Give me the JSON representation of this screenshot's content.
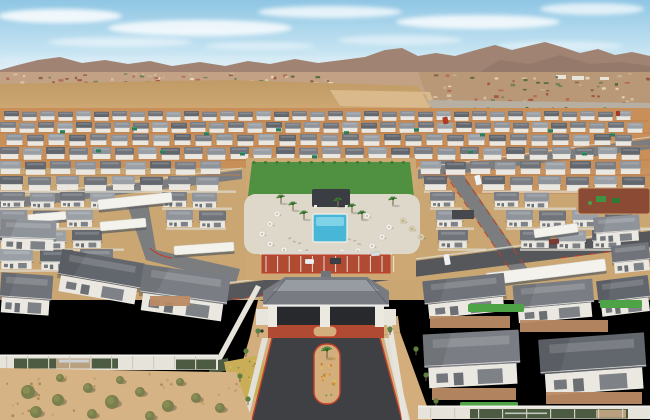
{
  "scene": {
    "description": "Aerial drone photograph of a new single-family rental home community in the desert: rows of gray-roofed houses, central pool amenity with palms and umbrellas, gated entry drive with hip-roof gatehouse, perimeter walls with green banners, open desert field, existing suburb and mountain range on the horizon under a hazy blue sky"
  },
  "colors": {
    "sky_top": "#8fc6e4",
    "sky_mid": "#c2e2f1",
    "sky_horizon": "#e2f0f6",
    "cloud": "#ffffff",
    "mountain_far": "#a18373",
    "mountain_near": "#8d7163",
    "suburb_base": "#c2a184",
    "suburb_right": "#b99878",
    "desert_field": "#c9a26b",
    "desert_mound": "#dcbd8f",
    "arterial_road": "#b6afa2",
    "dirt_construction": "#c88f59",
    "ground_mid": "#c9a672",
    "street_gray": "#7b7d7f",
    "asphalt_new": "#3e4044",
    "sidewalk": "#ddd9cf",
    "red_curb": "#c23f28",
    "red_paving": "#b04a33",
    "wall_house": "#ebe8e1",
    "lawn": "#4f9140",
    "turf": "#4da345",
    "pool_water": "#48b7d7",
    "pool_shallow": "#7fd2e8",
    "pool_deck": "#ddd8ca",
    "pavilion": "#3a3d41",
    "umbrella_white": "#f1eee6",
    "umbrella_tan": "#d9c9a9",
    "canopy_white": "#f4f2ec",
    "dumpster_green": "#2e7c5c",
    "banner_green": "#4d5b43",
    "banner_photo": "#b9a07e",
    "perimeter_wall": "#e6e3db",
    "paver": "#bb8a64",
    "gravel": "#d3ae7c",
    "shrub": "#7b7f4e",
    "palm_frond": "#3e7a33",
    "palm_trunk": "#8a7354",
    "flower_patch": "#c9ae57",
    "playground_mulch": "#8a4a34",
    "playground_green": "#3f9242",
    "gate_roof": "#787c82",
    "gate_roof_ridge": "#9aa0a6",
    "gate_opening": "#27292c",
    "column_white": "#ece9e1",
    "desert_foreground": "#d6b384",
    "roof_palette": [
      "#62666d",
      "#7a7e84",
      "#8f939a",
      "#70747a",
      "#9aa0a6"
    ]
  },
  "sky": {
    "clouds": [
      [
        60,
        16,
        62,
        7,
        0.85
      ],
      [
        200,
        28,
        92,
        8,
        0.8
      ],
      [
        330,
        12,
        72,
        6,
        0.75
      ],
      [
        478,
        22,
        82,
        7,
        0.8
      ],
      [
        592,
        9,
        52,
        6,
        0.7
      ],
      [
        120,
        42,
        72,
        5,
        0.5
      ],
      [
        400,
        40,
        62,
        5,
        0.45
      ],
      [
        560,
        46,
        62,
        5,
        0.4
      ],
      [
        260,
        46,
        55,
        4,
        0.4
      ]
    ]
  },
  "horizon": {
    "speck_count": 150,
    "tree_count": 16,
    "white_buildings": [
      [
        556,
        75,
        10,
        4
      ],
      [
        572,
        76,
        12,
        4
      ],
      [
        600,
        77,
        9,
        3
      ]
    ]
  },
  "layout": {
    "house_rows": [
      {
        "y": 111,
        "w": 15,
        "h": 9,
        "gap": 3,
        "segments": [
          [
            4,
            648
          ]
        ]
      },
      {
        "y": 122,
        "w": 16,
        "h": 10,
        "gap": 3,
        "segments": [
          [
            0,
            650
          ]
        ]
      },
      {
        "y": 134,
        "w": 17,
        "h": 11,
        "gap": 4,
        "segments": [
          [
            6,
            648
          ]
        ]
      },
      {
        "y": 147,
        "w": 19,
        "h": 12,
        "gap": 4,
        "segments": [
          [
            0,
            650
          ]
        ]
      },
      {
        "y": 161,
        "w": 21,
        "h": 13,
        "gap": 4,
        "segments": [
          [
            0,
            240
          ],
          [
            250,
            410
          ],
          [
            420,
            650
          ]
        ]
      },
      {
        "y": 176,
        "w": 23,
        "h": 14,
        "gap": 5,
        "segments": [
          [
            0,
            236
          ],
          [
            424,
            452
          ],
          [
            482,
            650
          ]
        ]
      },
      {
        "y": 192,
        "w": 25,
        "h": 15,
        "gap": 5,
        "segments": [
          [
            0,
            126
          ],
          [
            162,
            232
          ],
          [
            430,
            462
          ],
          [
            494,
            576
          ]
        ]
      },
      {
        "y": 210,
        "w": 27,
        "h": 17,
        "gap": 6,
        "segments": [
          [
            0,
            122
          ],
          [
            166,
            226
          ],
          [
            436,
            474
          ],
          [
            506,
            650
          ]
        ]
      },
      {
        "y": 230,
        "w": 30,
        "h": 18,
        "gap": 6,
        "segments": [
          [
            0,
            124
          ],
          [
            438,
            486
          ],
          [
            520,
            650
          ]
        ]
      },
      {
        "y": 249,
        "w": 33,
        "h": 20,
        "gap": 7,
        "segments": [
          [
            0,
            116
          ]
        ]
      }
    ],
    "front_houses": [
      [
        594,
        216,
        46,
        26,
        -4,
        2
      ],
      [
        0,
        220,
        56,
        30,
        2,
        2
      ],
      [
        612,
        244,
        38,
        28,
        -6,
        3
      ],
      [
        58,
        256,
        84,
        42,
        10,
        0
      ],
      [
        140,
        270,
        88,
        46,
        8,
        1
      ],
      [
        0,
        274,
        52,
        40,
        4,
        3
      ],
      [
        424,
        277,
        82,
        38,
        -6,
        3
      ],
      [
        598,
        278,
        52,
        36,
        -7,
        0
      ],
      [
        514,
        282,
        80,
        38,
        -5,
        1
      ],
      [
        424,
        332,
        96,
        54,
        -3,
        1
      ],
      [
        540,
        336,
        106,
        56,
        -4,
        0
      ]
    ],
    "canopies": [
      [
        98,
        196,
        74,
        10,
        -6
      ],
      [
        100,
        220,
        46,
        9,
        -5
      ],
      [
        174,
        244,
        60,
        9,
        -4
      ],
      [
        534,
        226,
        44,
        9,
        -8
      ],
      [
        486,
        266,
        120,
        12,
        -7
      ],
      [
        28,
        213,
        38,
        8,
        -5
      ]
    ],
    "dumpsters": [
      [
        60,
        130
      ],
      [
        132,
        127
      ],
      [
        204,
        132
      ],
      [
        276,
        128
      ],
      [
        344,
        131
      ],
      [
        414,
        128
      ],
      [
        480,
        133
      ],
      [
        548,
        129
      ],
      [
        610,
        133
      ],
      [
        96,
        149
      ],
      [
        240,
        152
      ],
      [
        312,
        155
      ],
      [
        468,
        150
      ],
      [
        582,
        152
      ],
      [
        160,
        150
      ]
    ],
    "vehicles": [
      [
        475,
        175,
        6,
        10,
        -14,
        "#f2f3f4"
      ],
      [
        443,
        117,
        5,
        7,
        -12,
        "#b23a28"
      ],
      [
        616,
        111,
        4,
        5,
        0,
        "#a83a2c"
      ],
      [
        444,
        254,
        6,
        11,
        -10,
        "#eef0f1"
      ],
      [
        330,
        258,
        11,
        6,
        0,
        "#3a4145"
      ],
      [
        305,
        259,
        9,
        5,
        0,
        "#eceeef"
      ],
      [
        549,
        239,
        10,
        5,
        -6,
        "#7c3a33"
      ],
      [
        371,
        252,
        9,
        4,
        -4,
        "#d8dadb"
      ]
    ],
    "umbrellas_white": [
      [
        270,
        224
      ],
      [
        262,
        234
      ],
      [
        270,
        244
      ],
      [
        284,
        250
      ],
      [
        300,
        252
      ],
      [
        342,
        252
      ],
      [
        358,
        251
      ],
      [
        372,
        246
      ],
      [
        382,
        237
      ],
      [
        389,
        227
      ],
      [
        277,
        214
      ],
      [
        367,
        216
      ]
    ],
    "umbrellas_tan": [
      [
        403,
        221
      ],
      [
        412,
        229
      ],
      [
        421,
        237
      ]
    ],
    "palms": [
      [
        293,
        204
      ],
      [
        304,
        213
      ],
      [
        352,
        206
      ],
      [
        362,
        213
      ],
      [
        281,
        197
      ],
      [
        393,
        199
      ],
      [
        338,
        200
      ]
    ],
    "median_palm": [
      327,
      350
    ],
    "loungers": [
      [
        288,
        238
      ],
      [
        293,
        240.5
      ],
      [
        298,
        243
      ],
      [
        348,
        238
      ],
      [
        353,
        240.5
      ],
      [
        358,
        243
      ],
      [
        305,
        250
      ],
      [
        340,
        250
      ]
    ],
    "turf": [
      [
        57,
        393,
        22,
        11
      ],
      [
        468,
        304,
        56,
        8
      ],
      [
        460,
        402,
        58,
        9
      ],
      [
        556,
        406,
        64,
        9
      ],
      [
        600,
        300,
        42,
        8
      ]
    ],
    "paver_courts": [
      [
        430,
        316,
        80,
        12
      ],
      [
        520,
        320,
        88,
        12
      ],
      [
        150,
        296,
        40,
        10
      ],
      [
        432,
        388,
        84,
        12
      ],
      [
        546,
        392,
        96,
        12
      ]
    ],
    "shrubs": [
      [
        28,
        392,
        7
      ],
      [
        58,
        400,
        6
      ],
      [
        88,
        388,
        5
      ],
      [
        112,
        402,
        7
      ],
      [
        140,
        392,
        5
      ],
      [
        168,
        406,
        6
      ],
      [
        196,
        398,
        5
      ],
      [
        60,
        378,
        4
      ],
      [
        120,
        380,
        4
      ],
      [
        180,
        382,
        4
      ],
      [
        220,
        408,
        5
      ],
      [
        36,
        412,
        6
      ],
      [
        92,
        414,
        5
      ],
      [
        150,
        416,
        5
      ]
    ],
    "strip_trees": [
      [
        246,
        352
      ],
      [
        240,
        377
      ],
      [
        248,
        400
      ],
      [
        416,
        350
      ],
      [
        426,
        376
      ],
      [
        436,
        402
      ],
      [
        258,
        332
      ],
      [
        390,
        330
      ]
    ],
    "parking": {
      "x": 262,
      "y": 255,
      "w": 128,
      "h": 18,
      "stalls": 11
    },
    "flower_dot_count": 18,
    "patch_dot_count": 24,
    "hedge_dot_count": 14
  }
}
